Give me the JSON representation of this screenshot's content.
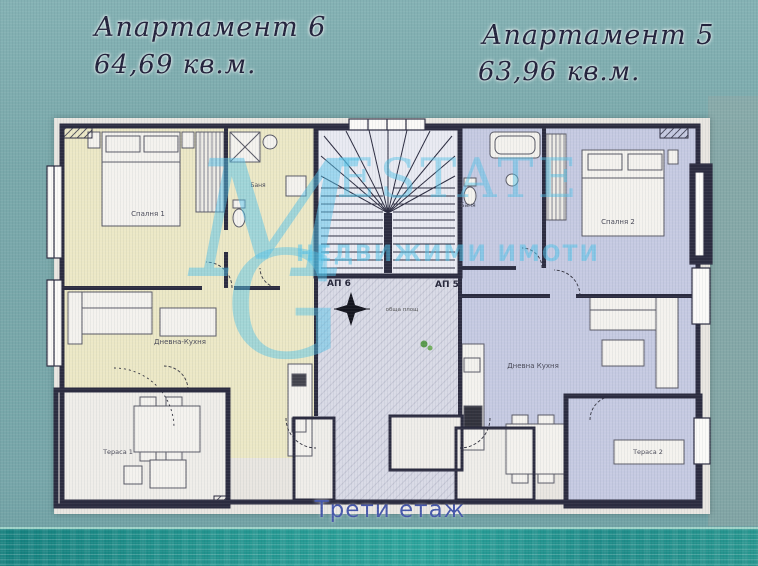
{
  "titles": {
    "apt6": "Апартамент 6",
    "apt6_area": "64,69 кв.м.",
    "apt5": "Апартамент 5",
    "apt5_area": "63,96 кв.м.",
    "floor": "Трети етаж"
  },
  "watermark": {
    "letter_m": "M",
    "letter_g": "G",
    "brand": "ESTATE",
    "tagline": "НЕДВИЖИМИ ИМОТИ"
  },
  "plan": {
    "entrance_left": "АП 6",
    "entrance_right": "АП 5",
    "rooms": {
      "bedroom1": "Спалня 1",
      "bedroom2": "Спалня 2",
      "living1": "Дневна-Кухня",
      "living2": "Дневна Кухня",
      "bath1": "Баня",
      "bath2": "Баня",
      "terrace1": "Тераса 1",
      "terrace2": "Тераса 2",
      "corridor_note": "обща площ"
    },
    "colors": {
      "apt6_fill": "#ece8c6",
      "apt5_fill": "#c6cae2",
      "corridor_fill": "#d9dae6",
      "wall": "#2c2c40",
      "watermark_cyan": "#54c2e9",
      "background_teal": "#7aa9ab",
      "water_teal": "#23958f",
      "floor_text": "#4758ab"
    }
  }
}
